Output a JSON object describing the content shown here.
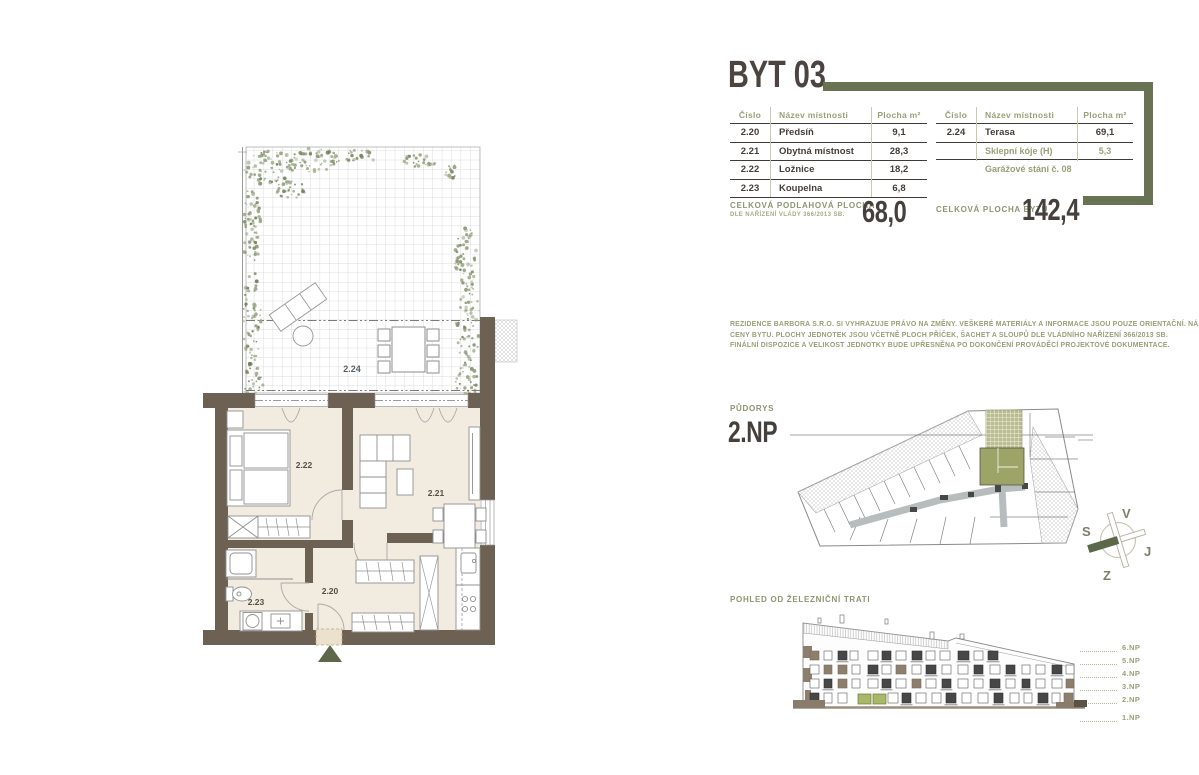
{
  "title": "BYT 03",
  "room_table": {
    "headers": {
      "number": "Číslo",
      "name": "Název místnosti",
      "area": "Plocha m²"
    },
    "rows": [
      {
        "number": "2.20",
        "name": "Předsíň",
        "area": "9,1"
      },
      {
        "number": "2.21",
        "name": "Obytná místnost",
        "area": "28,3"
      },
      {
        "number": "2.22",
        "name": "Ložnice",
        "area": "18,2"
      },
      {
        "number": "2.23",
        "name": "Koupelna",
        "area": "6,8"
      }
    ],
    "total": {
      "label": "CELKOVÁ PODLAHOVÁ PLOCHA",
      "sublabel": "DLE NAŘÍZENÍ VLÁDY 366/2013 SB.",
      "value": "68,0"
    }
  },
  "exterior_table": {
    "headers": {
      "number": "Číslo",
      "name": "Název místnosti",
      "area": "Plocha m²"
    },
    "rows": [
      {
        "number": "2.24",
        "name": "Terasa",
        "area": "69,1"
      },
      {
        "number": "",
        "name": "Sklepní kóje (H)",
        "area": "5,3"
      }
    ],
    "note": "Garážové stání č. 08",
    "total": {
      "label": "CELKOVÁ PLOCHA BYTU",
      "value": "142,4"
    }
  },
  "disclaimer": {
    "line1": "REZIDENCE BARBORA S.R.O. SI VYHRAZUJE PRÁVO NA ZMĚNY. VEŠKERÉ MATERIÁLY A INFORMACE JSOU POUZE ORIENTAČNÍ. NÁBYTEK NENÍ SOUČÁSTÍ KUPNÍ",
    "line2": "CENY BYTU. PLOCHY JEDNOTEK JSOU VČETNĚ PLOCH PŘÍČEK, ŠACHET A SLOUPŮ DLE VLÁDNÍHO NAŘÍZENÍ 366/2013 SB.",
    "line3": "FINÁLNÍ DISPOZICE A VELIKOST JEDNOTKY BUDE UPŘESNĚNA PO DOKONČENÍ PROVÁDĚCÍ PROJEKTOVÉ DOKUMENTACE."
  },
  "floor_plan_label": {
    "label": "PŮDORYS",
    "floor": "2.NP"
  },
  "elevation": {
    "label": "POHLED OD ŽELEZNIČNÍ TRATI",
    "floors": [
      "6.NP",
      "5.NP",
      "4.NP",
      "3.NP",
      "2.NP",
      "1.NP"
    ]
  },
  "compass": {
    "top": "V",
    "left": "S",
    "right": "J",
    "bottom": "Z"
  },
  "apartment_rooms": {
    "hall": "2.20",
    "living": "2.21",
    "bedroom": "2.22",
    "bathroom": "2.23",
    "terrace": "2.24"
  },
  "colors": {
    "olive_accent": "#6a7254",
    "olive_text": "#98a078",
    "dark_text": "#45403b",
    "wall": "#6d6154",
    "floor": "#f2ebe0",
    "unit_highlight": "#9ca468",
    "foliage": "#7d8b63"
  }
}
